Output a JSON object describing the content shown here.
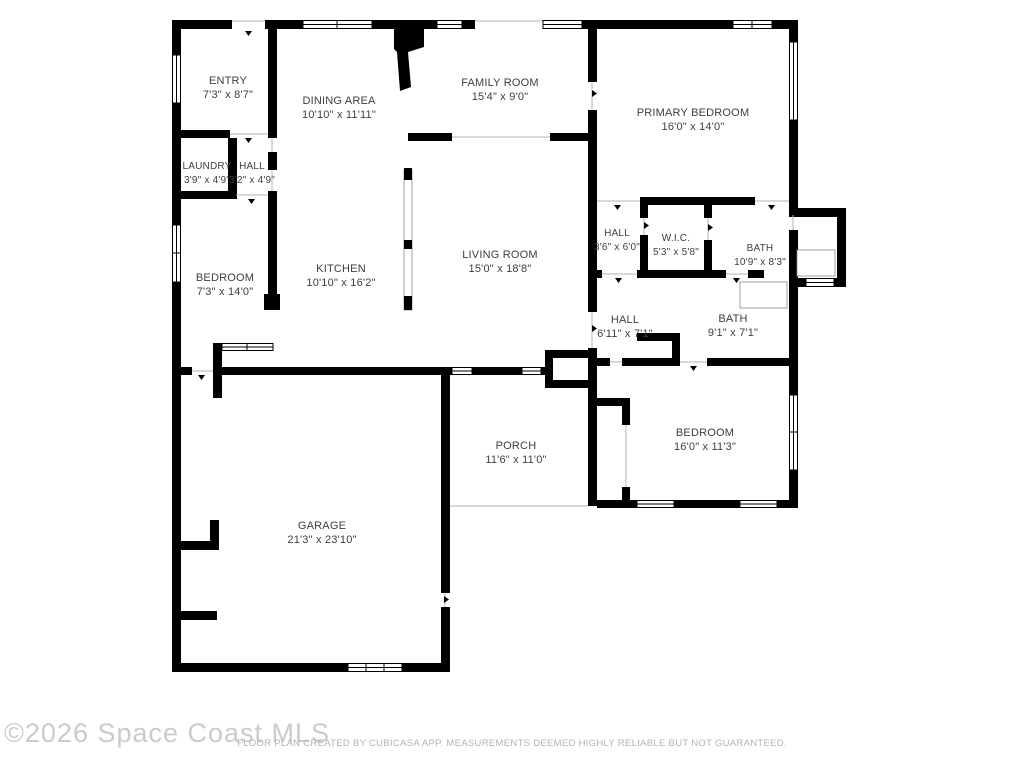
{
  "plan": {
    "rooms": [
      {
        "id": "entry",
        "name": "ENTRY",
        "dims": "7'3\" x 8'7\""
      },
      {
        "id": "dining",
        "name": "DINING AREA",
        "dims": "10'10\" x 11'11\""
      },
      {
        "id": "family",
        "name": "FAMILY ROOM",
        "dims": "15'4\" x 9'0\""
      },
      {
        "id": "primary",
        "name": "PRIMARY BEDROOM",
        "dims": "16'0\" x 14'0\""
      },
      {
        "id": "laundry",
        "name": "LAUNDRY",
        "dims": "3'9\" x 4'9\""
      },
      {
        "id": "hall-small",
        "name": "HALL",
        "dims": "3'2\" x 4'9\""
      },
      {
        "id": "bedroom-left",
        "name": "BEDROOM",
        "dims": "7'3\" x 14'0\""
      },
      {
        "id": "kitchen",
        "name": "KITCHEN",
        "dims": "10'10\" x 16'2\""
      },
      {
        "id": "living",
        "name": "LIVING ROOM",
        "dims": "15'0\" x 18'8\""
      },
      {
        "id": "hall-mid",
        "name": "HALL",
        "dims": "3'6\" x 6'0\""
      },
      {
        "id": "wic",
        "name": "W.I.C.",
        "dims": "5'3\" x 5'8\""
      },
      {
        "id": "bath-primary",
        "name": "BATH",
        "dims": "10'9\" x 8'3\""
      },
      {
        "id": "hall-lower",
        "name": "HALL",
        "dims": "6'11\" x 7'1\""
      },
      {
        "id": "bath-hall",
        "name": "BATH",
        "dims": "9'1\" x 7'1\""
      },
      {
        "id": "porch",
        "name": "PORCH",
        "dims": "11'6\" x 11'0\""
      },
      {
        "id": "bedroom-right",
        "name": "BEDROOM",
        "dims": "16'0\" x 11'3\""
      },
      {
        "id": "garage",
        "name": "GARAGE",
        "dims": "21'3\" x 23'10\""
      }
    ],
    "footer": {
      "watermark": "©2026 Space Coast MLS",
      "disclaimer": "FLOOR PLAN CREATED BY CUBICASA APP. MEASUREMENTS DEEMED HIGHLY RELIABLE BUT NOT GUARANTEED."
    },
    "colors": {
      "wall": "#000000",
      "label": "#3e3e3e",
      "opening_line": "#b3b3b3",
      "watermark": "#cbcbcb",
      "disclaimer": "#b3b3b3"
    }
  }
}
